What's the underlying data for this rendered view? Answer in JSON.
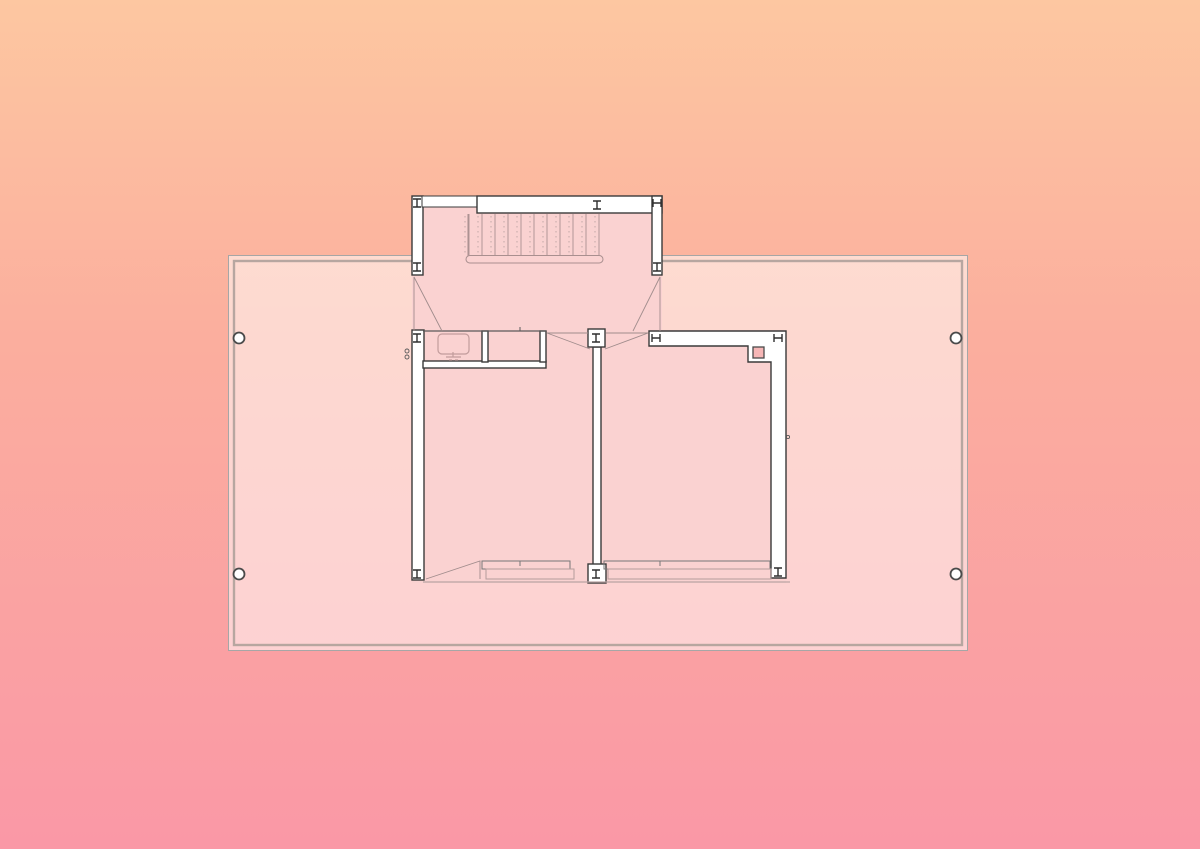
{
  "title": "floor-plan-drawing",
  "background": {
    "top": "#fdc7a1",
    "mid": "#fbae9e",
    "bottom": "#fa98a6"
  },
  "deck": {
    "fill": "rgba(255,255,255,0.52)",
    "outer_border": "#a6a6a6",
    "inner_border": "#b7a6a0",
    "column_fill": "#ffffff",
    "column_stroke": "#4a4a4a"
  },
  "plan": {
    "room_fill": "#fad2d1",
    "wall_fill": "#ffffff",
    "wall_stroke": "#3a3a3a",
    "thin_line": "#5a5a5a",
    "swing_line": "#a08c8c",
    "detail_line": "#a98f8f",
    "light_line": "#bba4a4",
    "window_dark": "#777777",
    "window_light": "#b49c9c",
    "column_glyph": "#2f2f2f",
    "flue_fill": "#f6b6b6",
    "flue_stroke": "#4a4a4a",
    "fixture_line": "#c29c9c"
  },
  "stair": {
    "tread_count": 11,
    "tread_start_x": 469,
    "tread_step": 13,
    "tread_top": 214,
    "tread_bottom": 255
  }
}
